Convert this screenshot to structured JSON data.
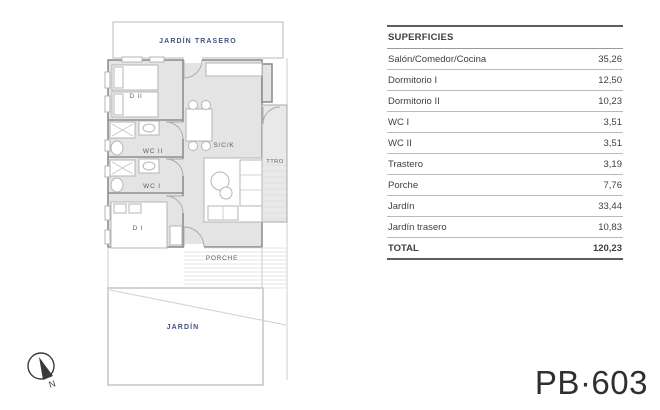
{
  "plan": {
    "labels": {
      "jardin_trasero": "JARDÍN TRASERO",
      "dormitorio2": "D II",
      "wc2": "WC II",
      "wc1": "WC I",
      "dormitorio1": "D I",
      "salon_comedor_cocina": "S/C/K",
      "trastero": "TTRO",
      "porche": "PORCHE",
      "jardin": "JARDÍN",
      "north": "N"
    },
    "colors": {
      "garden_label": "#46527b",
      "room_label": "#5f5f5f",
      "wall": "#8f8f8f",
      "floor_fill": "#e4e4e4"
    }
  },
  "table": {
    "header": "SUPERFICIES",
    "rows": [
      {
        "label": "Salón/Comedor/Cocina",
        "value": "35,26"
      },
      {
        "label": "Dormitorio I",
        "value": "12,50"
      },
      {
        "label": "Dormitorio II",
        "value": "10,23"
      },
      {
        "label": "WC I",
        "value": "3,51"
      },
      {
        "label": "WC II",
        "value": "3,51"
      },
      {
        "label": "Trastero",
        "value": "3,19"
      },
      {
        "label": "Porche",
        "value": "7,76"
      },
      {
        "label": "Jardín",
        "value": "33,44"
      },
      {
        "label": "Jardín trasero",
        "value": "10,83"
      }
    ],
    "total": {
      "label": "TOTAL",
      "value": "120,23"
    }
  },
  "unit_code": "PB·603"
}
